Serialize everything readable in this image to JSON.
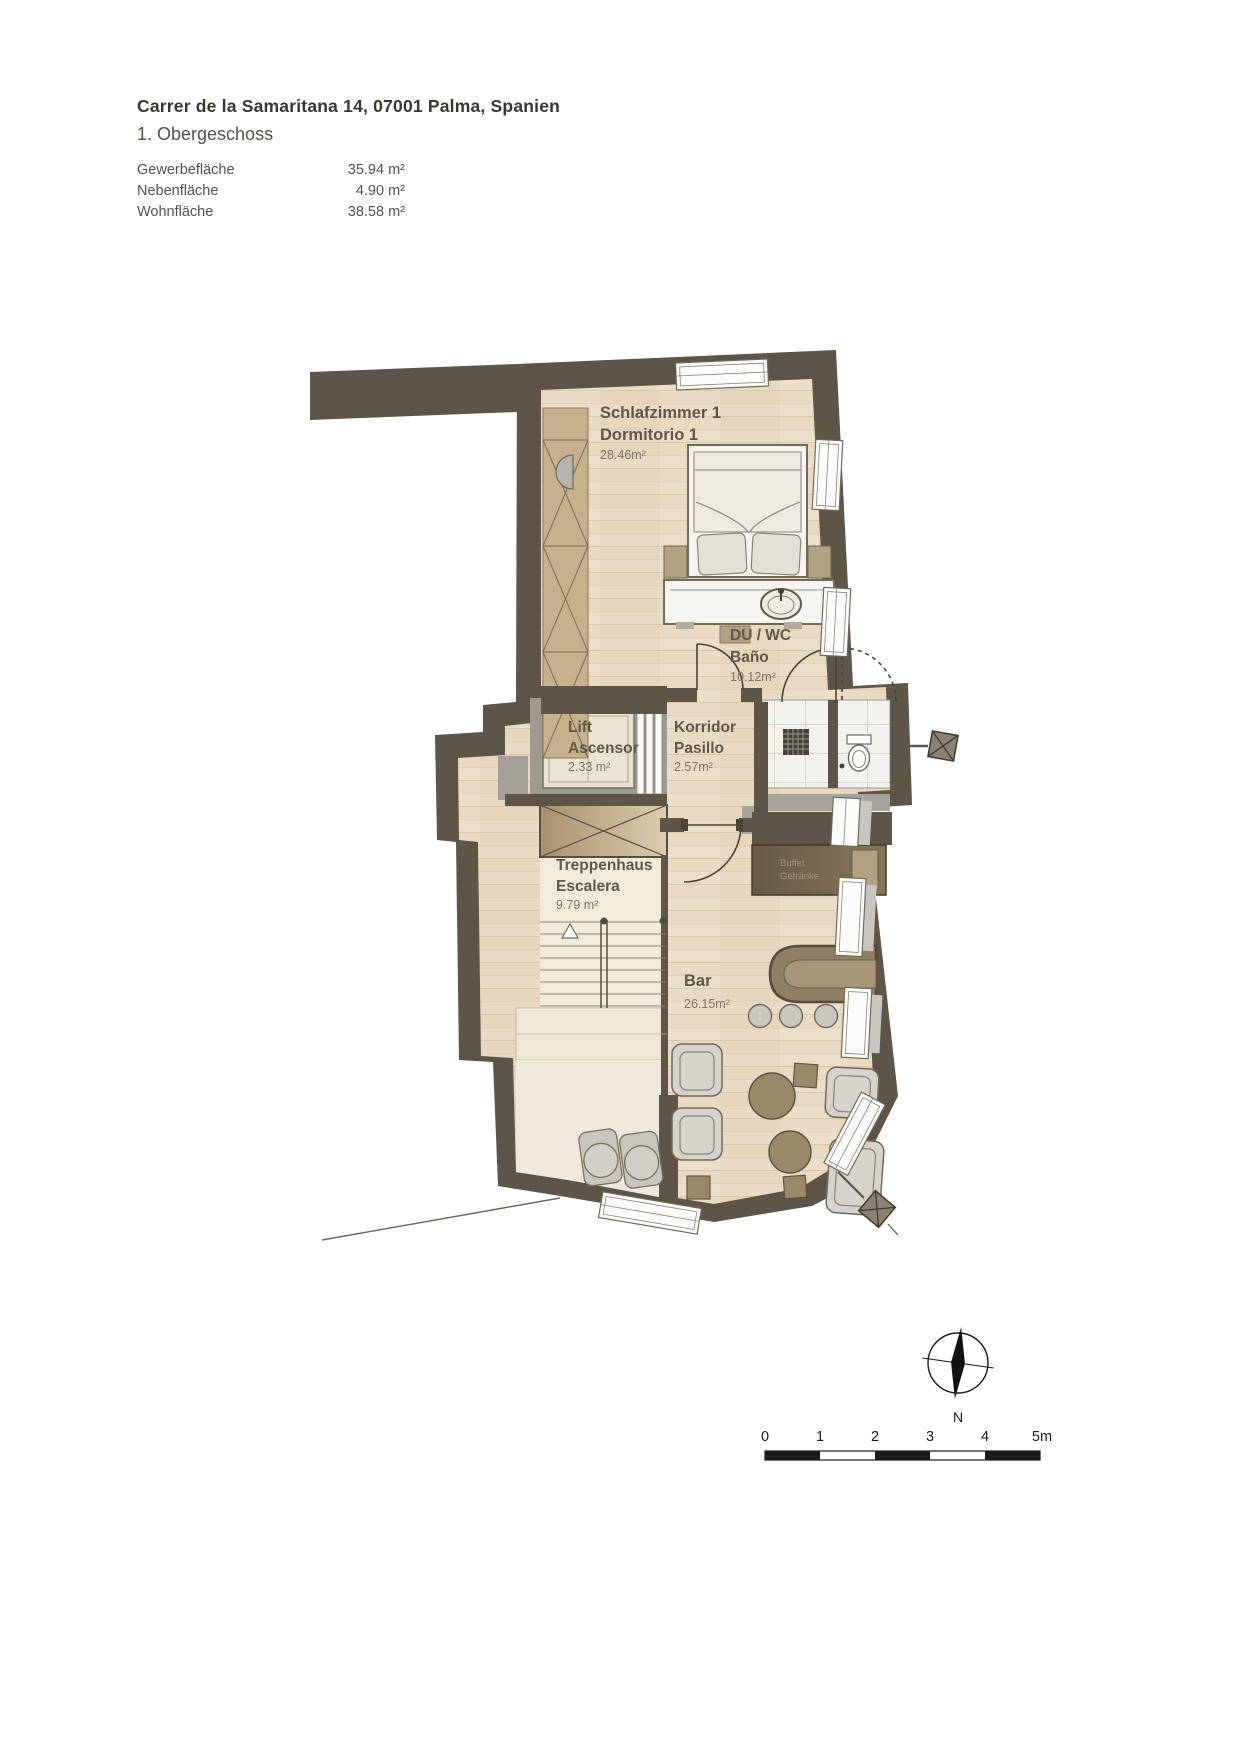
{
  "header": {
    "title": "Carrer de la Samaritana 14, 07001 Palma, Spanien",
    "floor": "1. Obergeschoss",
    "areas": [
      {
        "label": "Gewerbefläche",
        "value": "35.94 m²"
      },
      {
        "label": "Nebenfläche",
        "value": "4.90 m²"
      },
      {
        "label": "Wohnfläche",
        "value": "38.58 m²"
      }
    ]
  },
  "plan": {
    "rooms": [
      {
        "name_de": "Schlafzimmer 1",
        "name_es": "Dormitorio 1",
        "area": "28.46m²"
      },
      {
        "name_de": "DU / WC",
        "name_es": "Baño",
        "area": "10.12m²"
      },
      {
        "name_de": "Lift",
        "name_es": "Ascensor",
        "area": "2.33 m²"
      },
      {
        "name_de": "Korridor",
        "name_es": "Pasillo",
        "area": "2.57m²"
      },
      {
        "name_de": "Treppenhaus",
        "name_es": "Escalera",
        "area": "9.79 m²"
      },
      {
        "name_de": "Bar",
        "name_es": "",
        "area": "26.15m²"
      }
    ],
    "annotations": {
      "buffet_line1": "Buffet",
      "buffet_line2": "Getränke"
    },
    "compass_label": "N",
    "scalebar_labels": [
      "0",
      "1",
      "2",
      "3",
      "4",
      "5m"
    ],
    "colors": {
      "wall": "#5d5547",
      "wood_floor": "#e8dac3",
      "tile": "#f4f2ec",
      "stair_cream": "#f1ebdc",
      "wardrobe_tan": "#c7b18a",
      "lift_gray": "#9e9a90",
      "buffet_dark": "#6f6250",
      "bar_counter": "#8f7f64",
      "furniture_gray": "#d6d3cc",
      "table_brown": "#9b8a68",
      "label_text": "#5f5849",
      "area_text": "#7d7565"
    }
  }
}
